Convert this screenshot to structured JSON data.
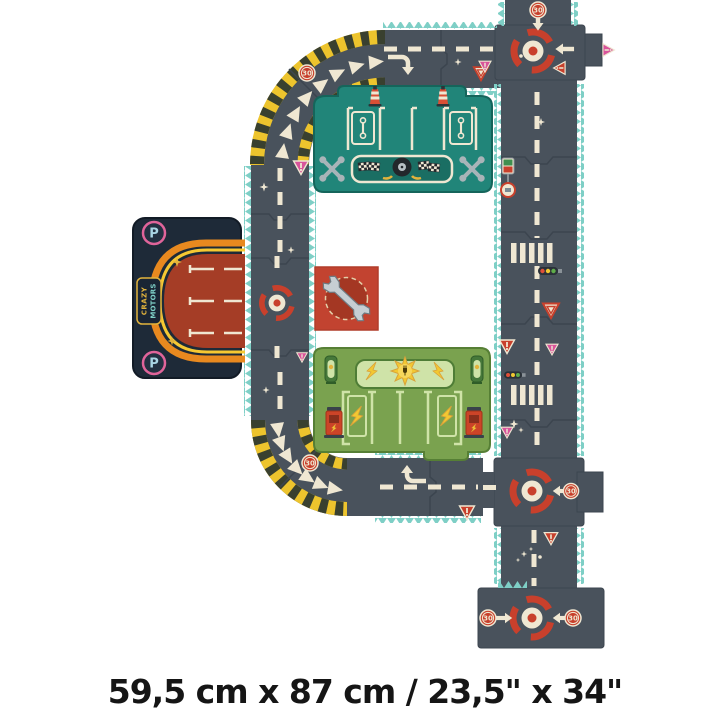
{
  "product": {
    "title": "Crazy Motors giant road puzzle",
    "dimensions_label": "59,5 cm x 87 cm / 23,5\" x 34\""
  },
  "signs": {
    "speed_limit": "30",
    "parking": "P"
  },
  "logo": {
    "line1": "CRAZY",
    "line2": "MOTORS"
  },
  "icons": [
    "roundabout-icon",
    "speed-30-sign",
    "yield-sign-icon",
    "warning-sign-icon",
    "traffic-light-icon",
    "fuel-sign-icon",
    "crosswalk",
    "chevron-arrow",
    "turn-arrow-icon",
    "wrench-icon",
    "crossed-wrenches-icon",
    "tire-icon",
    "checkered-flag-icon",
    "traffic-cone-icon",
    "lightning-bolt-icon",
    "sun-plug-icon",
    "charging-post-icon",
    "parking-p-badge",
    "sparkle-icon"
  ],
  "colors": {
    "background": "#ffffff",
    "road": "#49525c",
    "road_seam": "#3c454f",
    "edge_teal": "#7ecfc6",
    "lane_cream": "#efe7d2",
    "hazard_yellow": "#edc42d",
    "hazard_dark": "#39402f",
    "roundabout_red": "#c8402c",
    "sign_red": "#c8402c",
    "sign_pink": "#d8549b",
    "garage_teal": "#218579",
    "garage_teal_dark": "#15655b",
    "station_green": "#7aa24f",
    "station_green_dark": "#567f35",
    "station_green_light": "#cfe3a8",
    "parking_navy": "#1e2a38",
    "parking_rust": "#a53d26",
    "neon_orange": "#e8891f",
    "neon_yellow": "#f6c832",
    "accent_pink": "#e0649a",
    "card_red": "#c24330",
    "card_red_dark": "#a43723",
    "wrench_gray": "#c6ced3",
    "cone_red": "#d94f35",
    "metal_gray": "#a9b4b8",
    "gold": "#e2b33c",
    "text_black": "#151515"
  }
}
